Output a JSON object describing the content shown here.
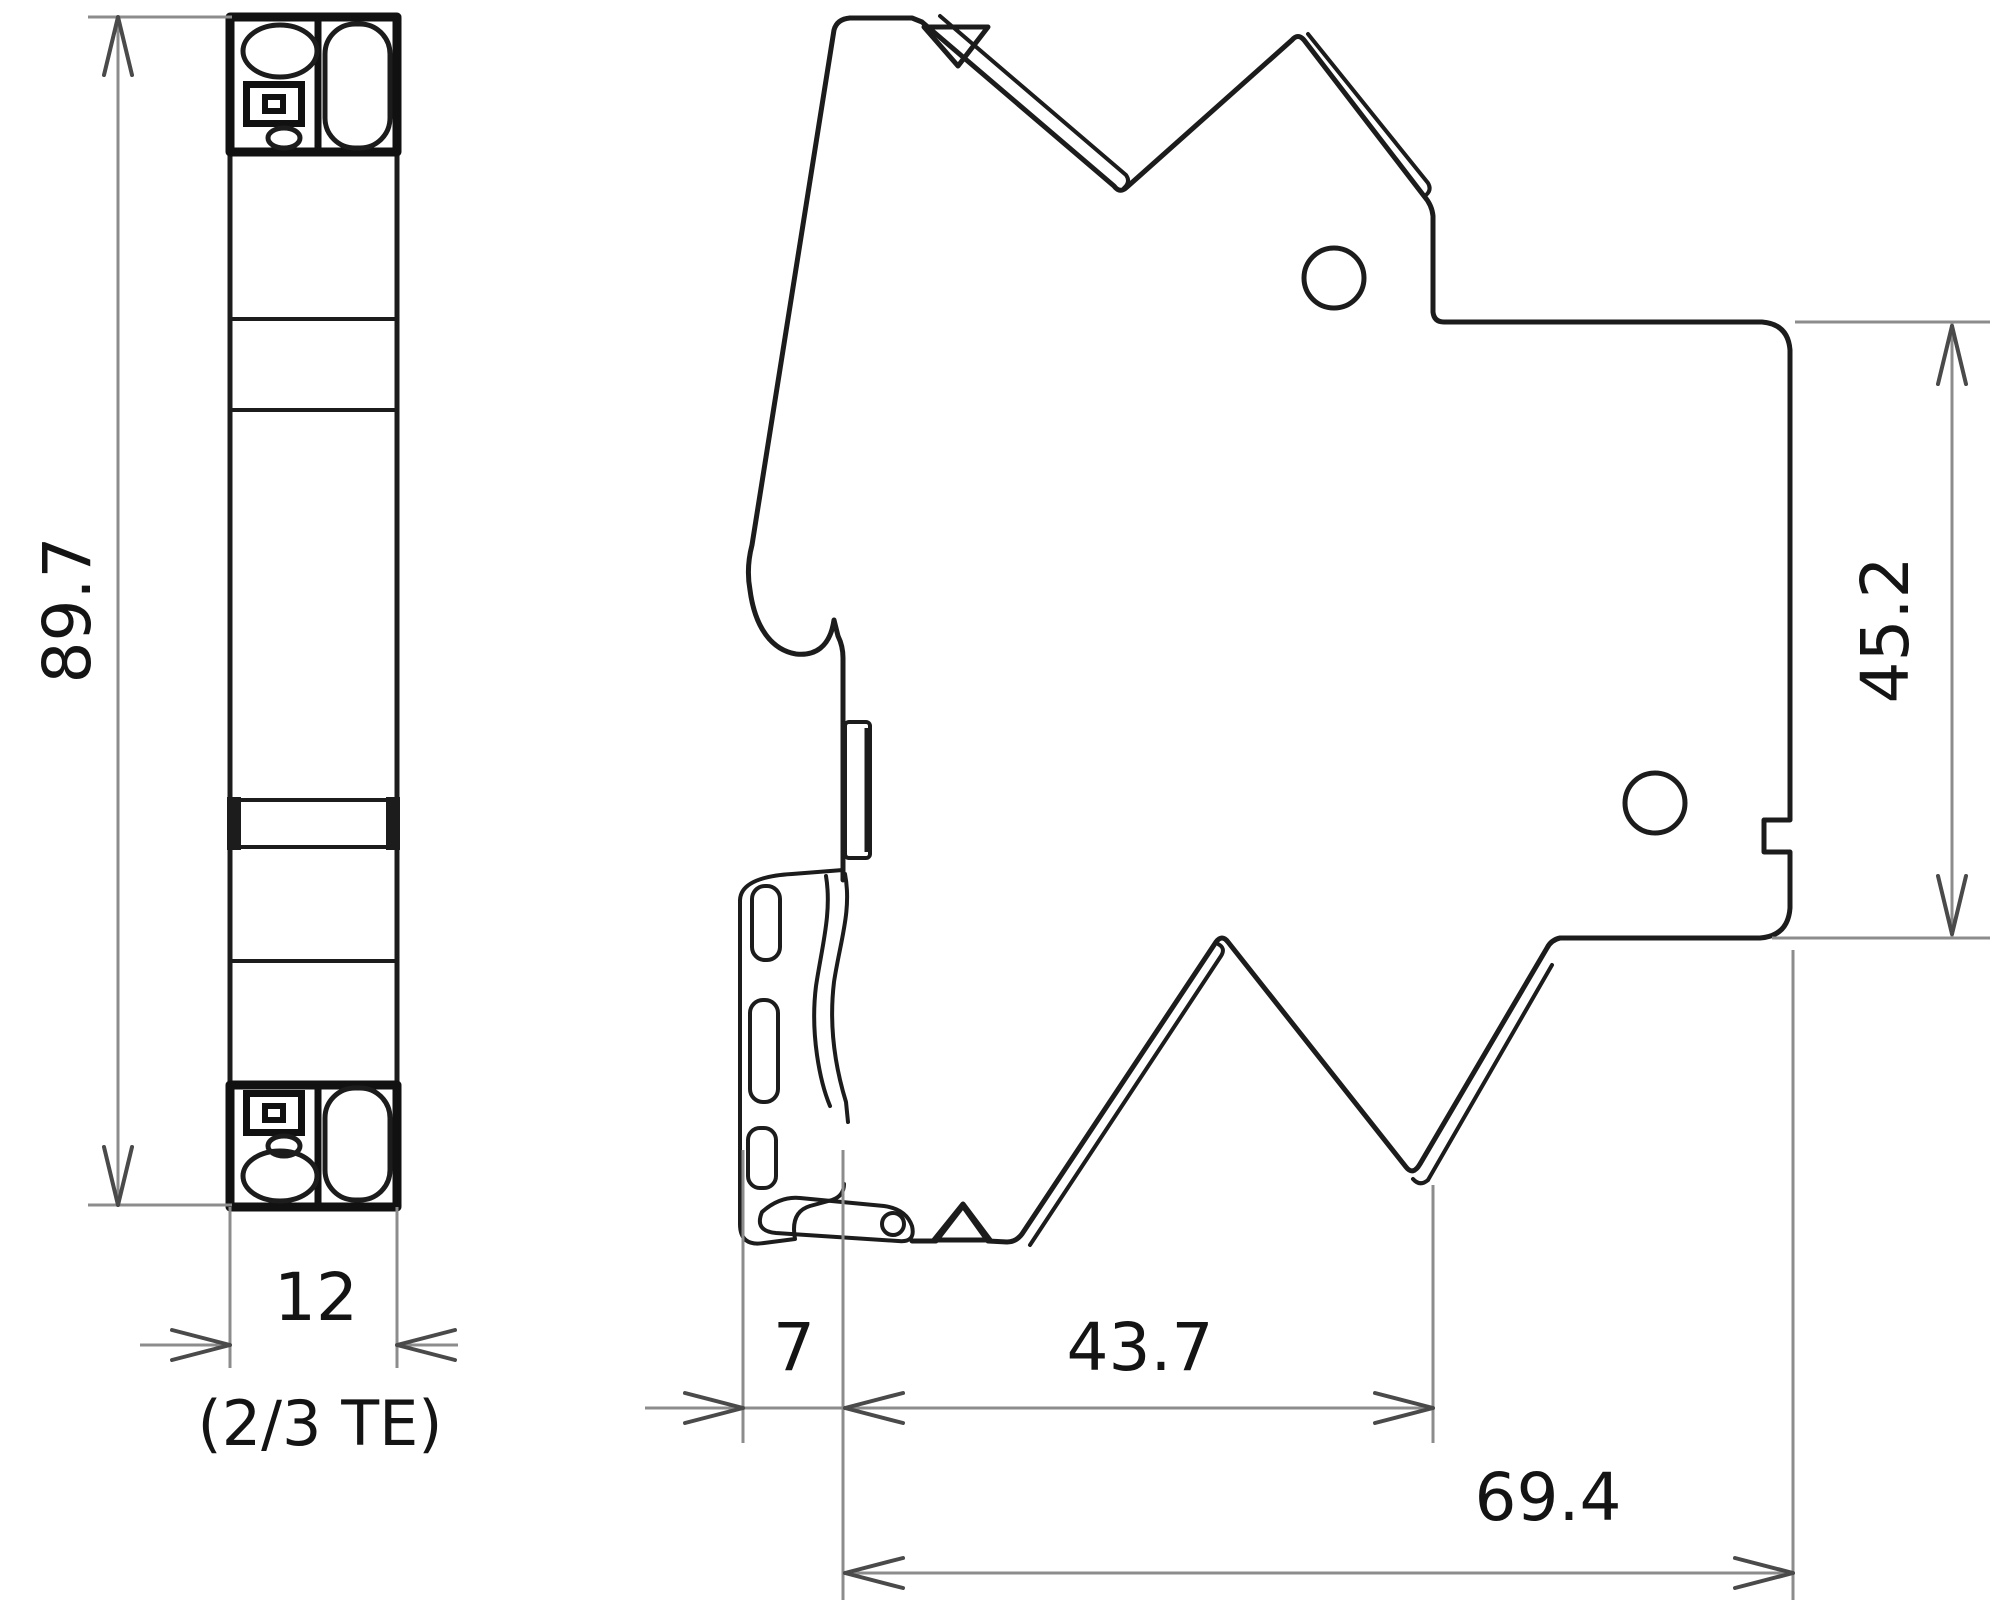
{
  "drawing": {
    "kind": "technical-dimension-drawing",
    "views": {
      "front": "front-view",
      "side": "side-view"
    },
    "dimensions": {
      "front_height": "89.7",
      "front_width": "12",
      "front_width_note": "(2/3 TE)",
      "side_right_height": "45.2",
      "side_clip_depth": "7",
      "side_body_depth": "43.7",
      "side_total_depth": "69.4"
    },
    "colors": {
      "outline": "#1c1c1c",
      "dimension_line": "#8c8c8c",
      "arrow": "#4a4a4a",
      "text": "#141414",
      "background": "#ffffff"
    }
  }
}
